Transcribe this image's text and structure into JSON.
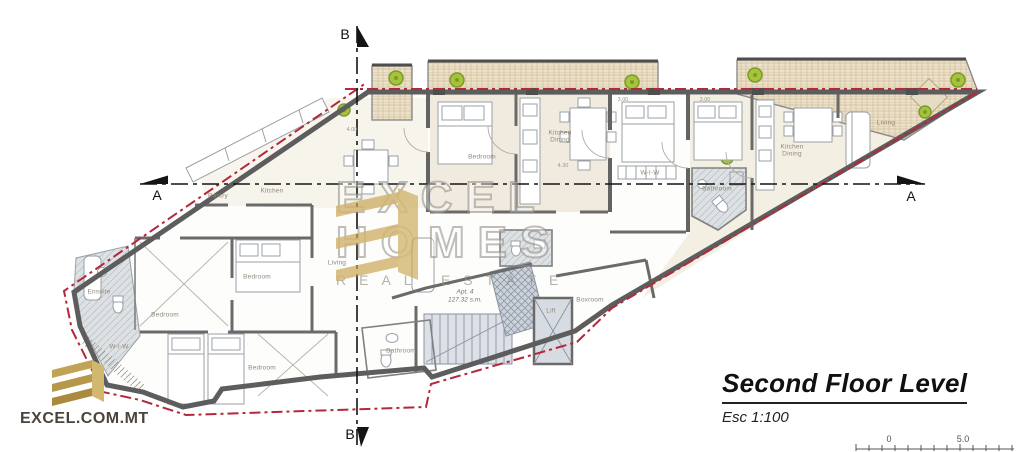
{
  "page": {
    "type": "architectural-floor-plan"
  },
  "title_block": {
    "title": "Second Floor Level",
    "scale": "Esc 1:100"
  },
  "branding": {
    "logo_text": "EXCEL.COM.MT",
    "watermark_line1": "EXCEL",
    "watermark_line2": "HOMES",
    "watermark_line3": "REAL ESTATE"
  },
  "section_markers": {
    "a": "A",
    "b": "B"
  },
  "scale_bar": {
    "zero": "0",
    "five": "5.0"
  },
  "apartment": {
    "name": "Apt. 4",
    "area": "127.32 s.m."
  },
  "rooms": [
    "Pantry",
    "Kitchen",
    "Bedroom",
    "Living",
    "Ensuite",
    "Bedroom",
    "W-I-W",
    "Bedroom",
    "Bedroom",
    "Kitchen Dining",
    "W-I-W",
    "Bathroom",
    "Kitchen Dining",
    "Living",
    "Boxroom",
    "Lift",
    "Bathroom"
  ],
  "dimensions": [
    "3.00",
    "3.00",
    "4.30",
    "4.00"
  ],
  "colors": {
    "boundary-red": "#b5273a",
    "wall-gray": "#5d5d5d",
    "terrace-beige": "#ece2cc",
    "gold": "#c3a14d",
    "plant-green": "#a6c33d",
    "label-gray": "#8f897b"
  }
}
